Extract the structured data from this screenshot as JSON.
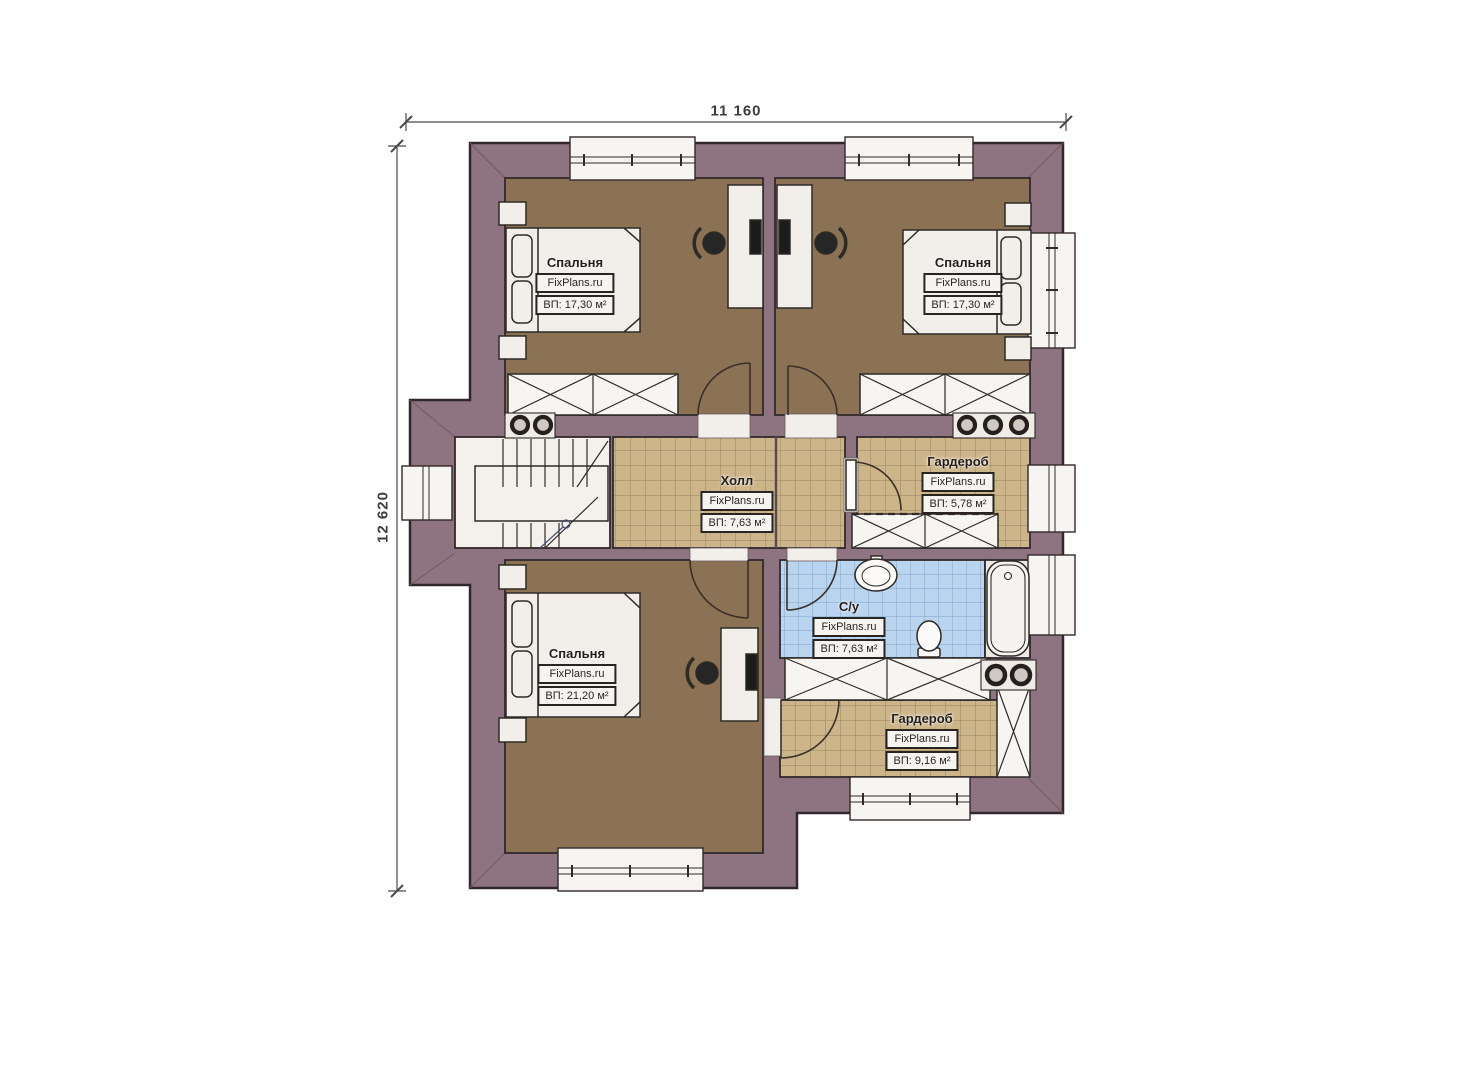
{
  "dimensions": {
    "width_label": "11 160",
    "height_label": "12 620"
  },
  "rooms": [
    {
      "id": "bedroom-top-left",
      "name": "Спальня",
      "brand": "FixPlans.ru",
      "area_label": "ВП: 17,30 м²"
    },
    {
      "id": "bedroom-top-right",
      "name": "Спальня",
      "brand": "FixPlans.ru",
      "area_label": "ВП: 17,30 м²"
    },
    {
      "id": "hall",
      "name": "Холл",
      "brand": "FixPlans.ru",
      "area_label": "ВП: 7,63 м²"
    },
    {
      "id": "wardrobe-upper",
      "name": "Гардероб",
      "brand": "FixPlans.ru",
      "area_label": "ВП: 5,78 м²"
    },
    {
      "id": "bathroom",
      "name": "С/у",
      "brand": "FixPlans.ru",
      "area_label": "ВП: 7,63 м²"
    },
    {
      "id": "wardrobe-lower",
      "name": "Гардероб",
      "brand": "FixPlans.ru",
      "area_label": "ВП: 9,16 м²"
    },
    {
      "id": "bedroom-bottom",
      "name": "Спальня",
      "brand": "FixPlans.ru",
      "area_label": "ВП: 21,20 м²"
    }
  ],
  "colors": {
    "wall": "#8d7480",
    "wall_outline": "#32282c",
    "bedroom_floor": "#8b7254",
    "tile_floor": "#cdb58a",
    "bathroom_tile": "#b9d4ef",
    "fixture_white": "#f4f1ed"
  }
}
